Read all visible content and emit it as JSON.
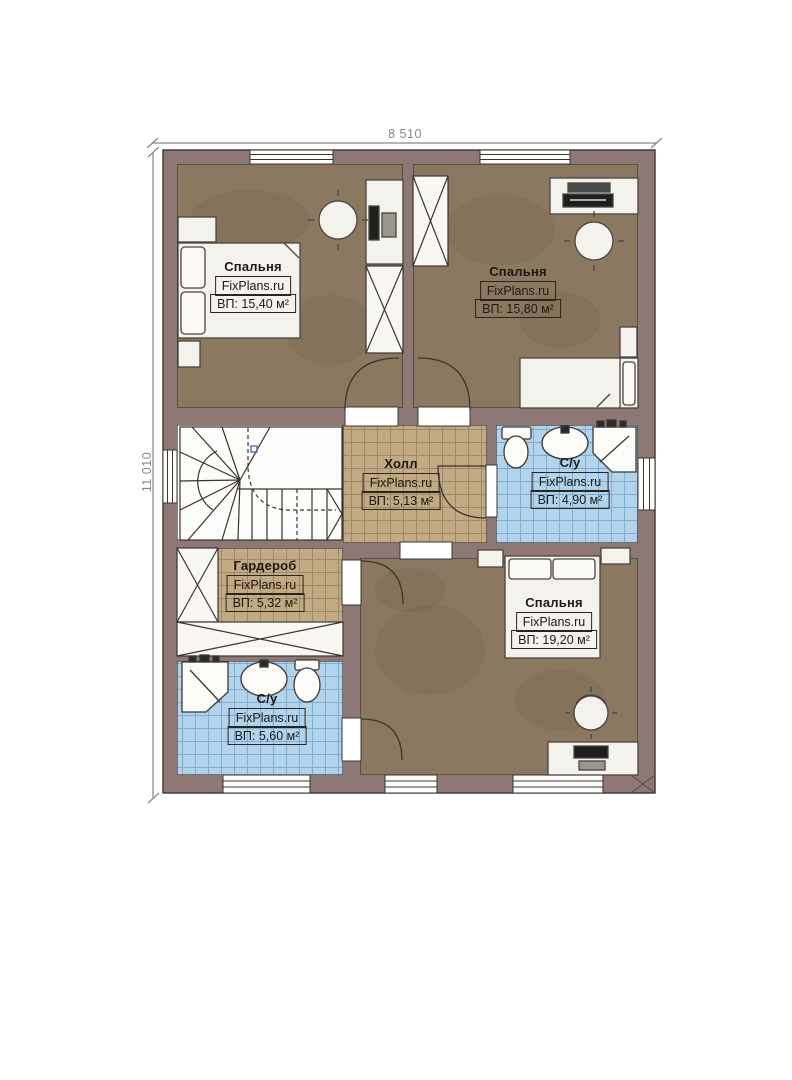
{
  "dimensions": {
    "width_label": "8 510",
    "height_label": "11 010"
  },
  "brand": "FixPlans.ru",
  "rooms": [
    {
      "id": "bedroom-top-left",
      "name": "Спальня",
      "brand": "FixPlans.ru",
      "area": "ВП: 15,40 м²"
    },
    {
      "id": "bedroom-top-right",
      "name": "Спальня",
      "brand": "FixPlans.ru",
      "area": "ВП: 15,80 м²"
    },
    {
      "id": "hall",
      "name": "Холл",
      "brand": "FixPlans.ru",
      "area": "ВП: 5,13 м²"
    },
    {
      "id": "bathroom-top",
      "name": "С/у",
      "brand": "FixPlans.ru",
      "area": "ВП: 4,90 м²"
    },
    {
      "id": "wardrobe",
      "name": "Гардероб",
      "brand": "FixPlans.ru",
      "area": "ВП: 5,32 м²"
    },
    {
      "id": "bedroom-bottom-right",
      "name": "Спальня",
      "brand": "FixPlans.ru",
      "area": "ВП: 19,20 м²"
    },
    {
      "id": "bathroom-bottom",
      "name": "С/у",
      "brand": "FixPlans.ru",
      "area": "ВП: 5,60 м²"
    }
  ],
  "colors": {
    "wall": "#8d7876",
    "wood_floor": "#8a7960",
    "tile_tan": "#c2aa85",
    "tile_tan_grid": "#a08866",
    "tile_blue": "#b1d3eb",
    "tile_blue_grid": "#82abd0",
    "line": "#3c352f",
    "dimension": "#878787",
    "label_text": "#1f1911"
  }
}
